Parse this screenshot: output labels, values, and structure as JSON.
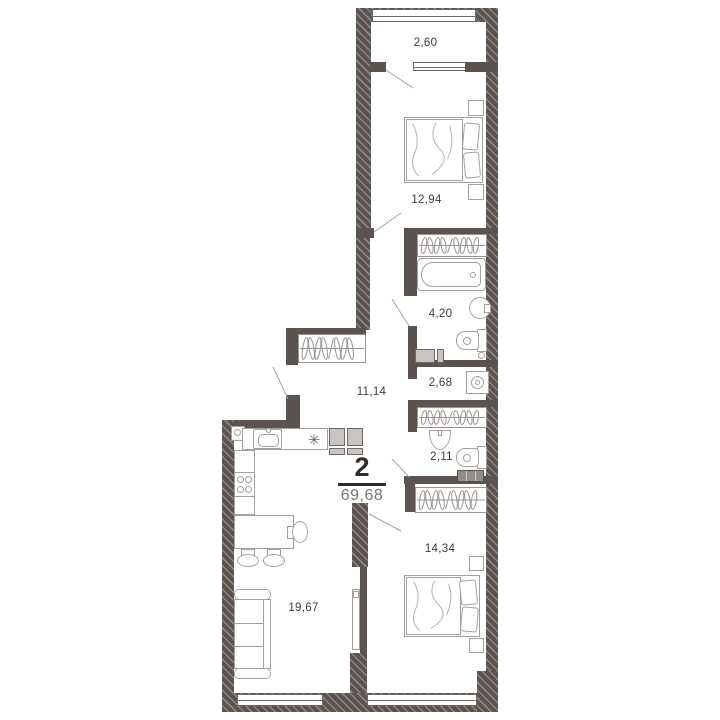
{
  "plan": {
    "summary": {
      "rooms_count": "2",
      "total_area": "69,68"
    },
    "rooms": [
      {
        "id": "balcony",
        "area": "2,60"
      },
      {
        "id": "bedroom-1",
        "area": "12,94"
      },
      {
        "id": "bathroom",
        "area": "4,20"
      },
      {
        "id": "hallway-niche",
        "area": "2,68"
      },
      {
        "id": "corridor",
        "area": "11,14"
      },
      {
        "id": "wc",
        "area": "2,11"
      },
      {
        "id": "bedroom-2",
        "area": "14,34"
      },
      {
        "id": "living-kitchen",
        "area": "19,67"
      }
    ],
    "kitchen": {
      "hob_symbol": "✳"
    },
    "colors": {
      "wall": "#5b534f",
      "furniture_outline": "#a6a09c",
      "appliance_fill": "#c8c4c2",
      "label_text": "#3f3b38",
      "summary_text": "#2f2b28",
      "total_area_text": "#7a7470",
      "background": "#ffffff"
    }
  }
}
